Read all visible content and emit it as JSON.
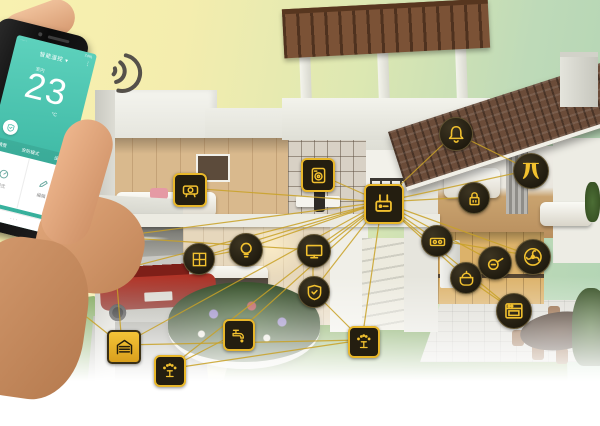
{
  "colors": {
    "accent_gold": "#e8b72a",
    "line_gold": "#c9a227",
    "icon_dark": "#241e10",
    "phone_teal": "#3cb7a3",
    "roof_brown": "#6b4c39",
    "lawn_green": "#7ca653",
    "car_red": "#9e2f24"
  },
  "phone": {
    "status_left": "·····",
    "status_right": "74%",
    "header": "智能温控",
    "header_caret": "▾",
    "more_icon": "⋮",
    "room_label": "室内",
    "temperature": "23",
    "unit": "°C",
    "menu_items": [
      "情景",
      "安防模式",
      "设置"
    ],
    "actions": [
      {
        "label": "模式"
      },
      {
        "label": "编辑"
      }
    ],
    "footer": "· · ·"
  },
  "network": {
    "icons": [
      {
        "name": "gateway-hub",
        "glyph": "router",
        "shape": "square",
        "x": 382,
        "y": 202,
        "size": 36
      },
      {
        "name": "bedroom-camera",
        "glyph": "cam2",
        "shape": "square",
        "x": 188,
        "y": 188,
        "size": 30
      },
      {
        "name": "study-appliance",
        "glyph": "washer",
        "shape": "square",
        "x": 316,
        "y": 173,
        "size": 30
      },
      {
        "name": "doorbell",
        "glyph": "bell",
        "shape": "circle",
        "x": 455,
        "y": 133,
        "size": 32
      },
      {
        "name": "curtain-control",
        "glyph": "curtain",
        "shape": "circle",
        "x": 530,
        "y": 170,
        "size": 34
      },
      {
        "name": "door-lock",
        "glyph": "lock",
        "shape": "circle",
        "x": 473,
        "y": 197,
        "size": 30
      },
      {
        "name": "power-strip",
        "glyph": "socket",
        "shape": "circle",
        "x": 436,
        "y": 240,
        "size": 30
      },
      {
        "name": "cooktop",
        "glyph": "pan",
        "shape": "circle",
        "x": 494,
        "y": 262,
        "size": 32
      },
      {
        "name": "ventilation-fan",
        "glyph": "fan",
        "shape": "circle",
        "x": 532,
        "y": 256,
        "size": 34
      },
      {
        "name": "rice-cooker",
        "glyph": "cooker",
        "shape": "circle",
        "x": 465,
        "y": 277,
        "size": 30
      },
      {
        "name": "oven",
        "glyph": "oven",
        "shape": "circle",
        "x": 513,
        "y": 310,
        "size": 34
      },
      {
        "name": "ceiling-light",
        "glyph": "bulb",
        "shape": "circle",
        "x": 245,
        "y": 249,
        "size": 32
      },
      {
        "name": "smart-tv",
        "glyph": "tv",
        "shape": "circle",
        "x": 313,
        "y": 250,
        "size": 32
      },
      {
        "name": "security-panel",
        "glyph": "shield",
        "shape": "circle",
        "x": 313,
        "y": 291,
        "size": 30
      },
      {
        "name": "floor-vent",
        "glyph": "grid",
        "shape": "circle",
        "x": 198,
        "y": 258,
        "size": 30
      },
      {
        "name": "cctv-camera",
        "glyph": "cctv",
        "shape": "circle",
        "x": 113,
        "y": 237,
        "size": 30
      },
      {
        "name": "smart-plug",
        "glyph": "plug",
        "shape": "square",
        "x": 50,
        "y": 288,
        "size": 30
      },
      {
        "name": "garage-door",
        "glyph": "garage",
        "shape": "square-solid",
        "x": 122,
        "y": 345,
        "size": 30
      },
      {
        "name": "garden-watering",
        "glyph": "sprinkler",
        "shape": "square",
        "x": 168,
        "y": 369,
        "size": 28
      },
      {
        "name": "irrigation-tap",
        "glyph": "tap",
        "shape": "square",
        "x": 237,
        "y": 333,
        "size": 28
      },
      {
        "name": "lawn-sprinkler",
        "glyph": "sprinkler",
        "shape": "square",
        "x": 362,
        "y": 340,
        "size": 28
      }
    ],
    "links": [
      [
        "gateway-hub",
        "bedroom-camera"
      ],
      [
        "gateway-hub",
        "study-appliance"
      ],
      [
        "gateway-hub",
        "doorbell"
      ],
      [
        "gateway-hub",
        "curtain-control"
      ],
      [
        "gateway-hub",
        "door-lock"
      ],
      [
        "gateway-hub",
        "power-strip"
      ],
      [
        "gateway-hub",
        "cooktop"
      ],
      [
        "gateway-hub",
        "ventilation-fan"
      ],
      [
        "gateway-hub",
        "rice-cooker"
      ],
      [
        "gateway-hub",
        "oven"
      ],
      [
        "gateway-hub",
        "ceiling-light"
      ],
      [
        "gateway-hub",
        "smart-tv"
      ],
      [
        "gateway-hub",
        "security-panel"
      ],
      [
        "gateway-hub",
        "floor-vent"
      ],
      [
        "gateway-hub",
        "cctv-camera"
      ],
      [
        "gateway-hub",
        "smart-plug"
      ],
      [
        "gateway-hub",
        "garage-door"
      ],
      [
        "gateway-hub",
        "garden-watering"
      ],
      [
        "gateway-hub",
        "irrigation-tap"
      ],
      [
        "gateway-hub",
        "lawn-sprinkler"
      ],
      [
        "cctv-camera",
        "garage-door"
      ],
      [
        "smart-plug",
        "garage-door"
      ],
      [
        "garage-door",
        "lawn-sprinkler"
      ],
      [
        "garden-watering",
        "lawn-sprinkler"
      ],
      [
        "irrigation-tap",
        "garden-watering"
      ],
      [
        "doorbell",
        "curtain-control"
      ],
      [
        "floor-vent",
        "ceiling-light"
      ],
      [
        "smart-tv",
        "security-panel"
      ],
      [
        "power-strip",
        "ventilation-fan"
      ],
      [
        "rice-cooker",
        "oven"
      ],
      [
        "cctv-camera",
        "smart-tv"
      ],
      [
        "security-panel",
        "lawn-sprinkler"
      ]
    ]
  }
}
